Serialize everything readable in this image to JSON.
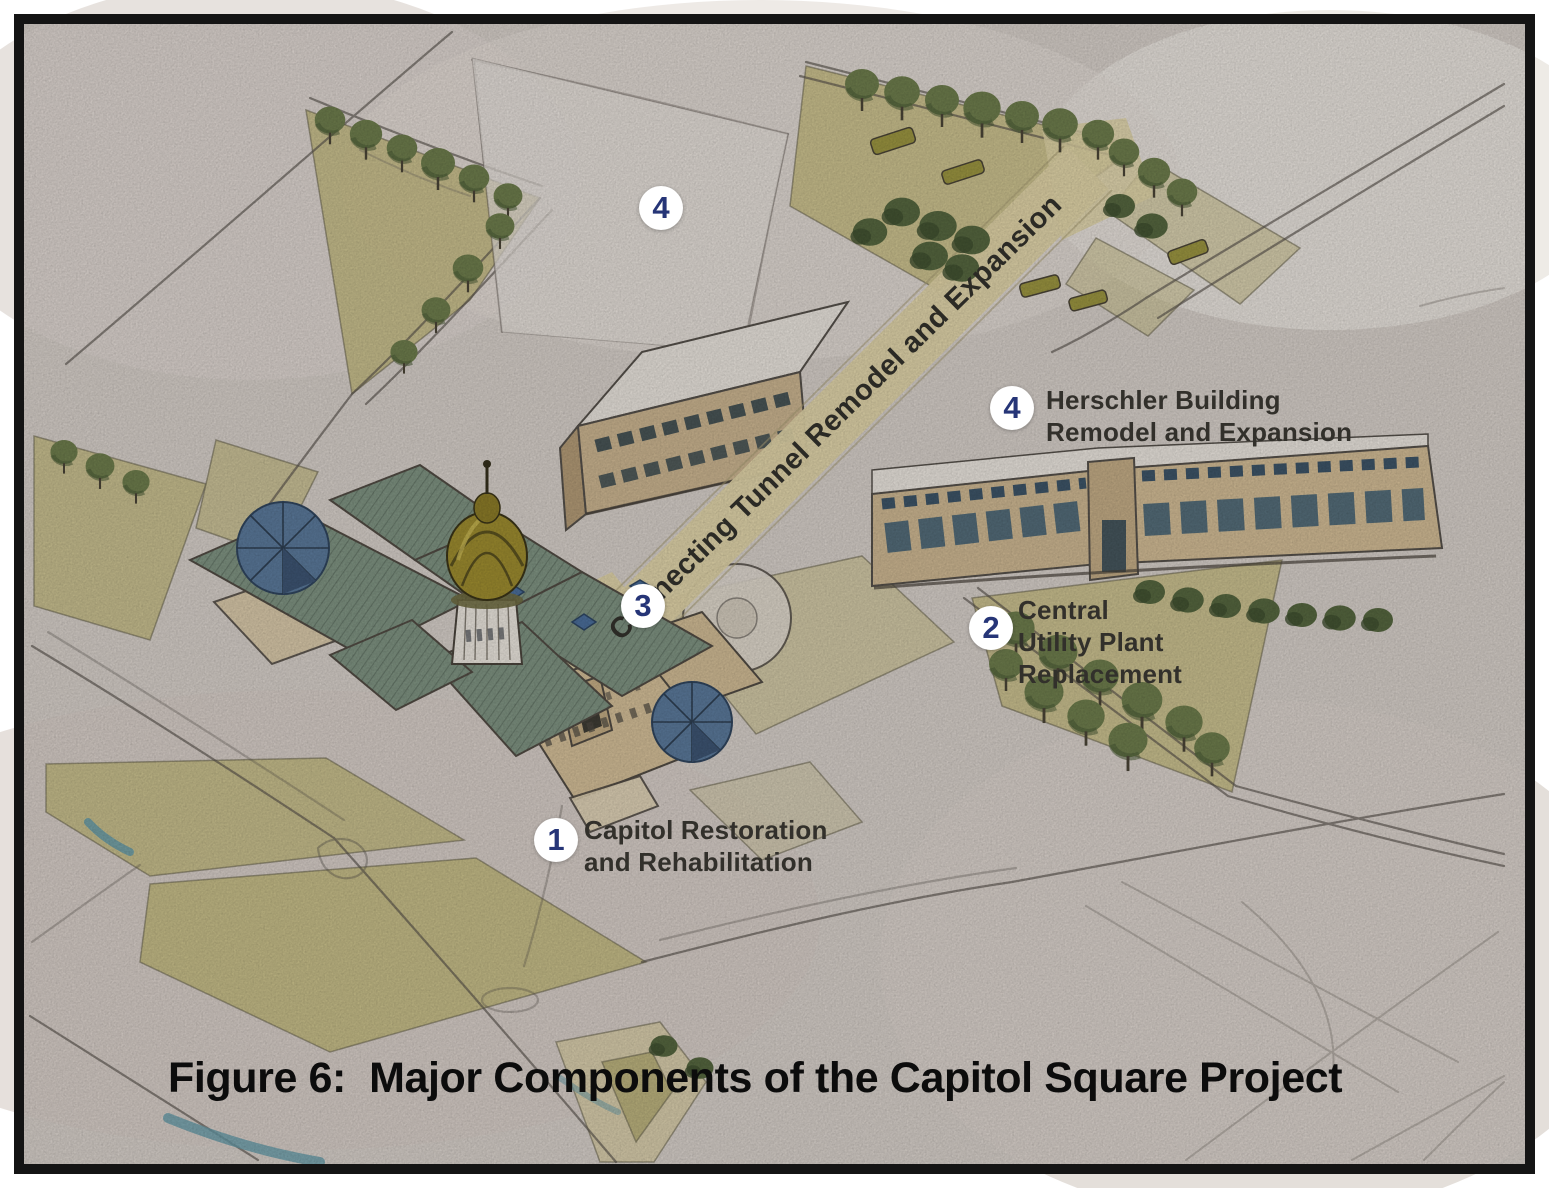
{
  "figure": {
    "caption": "Figure 6:  Major Components of the Capitol Square Project"
  },
  "annotations": {
    "capitol": {
      "number": "1",
      "label": "Capitol Restoration\nand Rehabilitation"
    },
    "utility": {
      "number": "2",
      "label": "Central\nUtility Plant\nReplacement"
    },
    "tunnel": {
      "number": "3",
      "label": "Connecting Tunnel Remodel and Expansion"
    },
    "herschler": {
      "number": "4",
      "label": "Herschler Building\nRemodel and Expansion"
    },
    "herschler_top": {
      "number": "4"
    }
  },
  "colors": {
    "frame": "#141414",
    "paper": "#D5CEC8",
    "marker_background": "#FFFFFF",
    "marker_number": "#263577",
    "label_text": "#32302B",
    "caption_text": "#0C0C0C",
    "tunnel_band": "#DED2A6",
    "lawn_olive": "#C2B980",
    "tree_green": "#6D7C4C",
    "roof_sage": "#7E9281",
    "wall_tan": "#D2BD97",
    "dome_gold": "#9C8B2F",
    "window_blue": "#2E4A63",
    "pavilion_blue": "#5A7899",
    "water_blue": "#649AA8",
    "sketch_line": "#57514B"
  }
}
